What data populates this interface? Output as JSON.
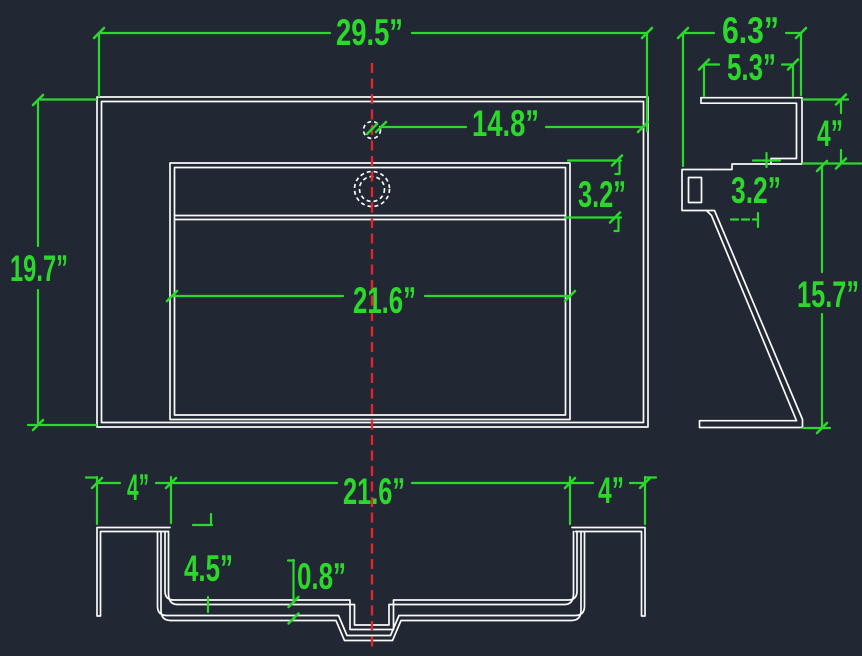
{
  "drawing": {
    "type": "cad-sink-dimension-drawing",
    "views": {
      "plan": "top view of sink with basin, faucet hole and drain",
      "side": "right side profile with backsplash and pedestal",
      "front": "front elevation with mounting legs and drain boss"
    }
  },
  "colors": {
    "background": "#212834",
    "object_lines": "#fafafa",
    "dimension_lines": "#2bd82b",
    "centerline": "#e82328"
  },
  "dimensions": {
    "plan_width": "29.5”",
    "plan_depth": "19.7”",
    "faucet_to_edge": "14.8”",
    "plan_ledge": "3.2”",
    "plan_basin": "21.6”",
    "side_depth_top": "6.3”",
    "side_depth_inner": "5.3”",
    "backsplash_height": "4”",
    "side_ledge": "3.2”",
    "side_height": "15.7”",
    "front_left_leg": "4”",
    "front_basin": "21.6”",
    "front_right_leg": "4”",
    "apron_height": "4.5”",
    "lip": "0.8”"
  }
}
